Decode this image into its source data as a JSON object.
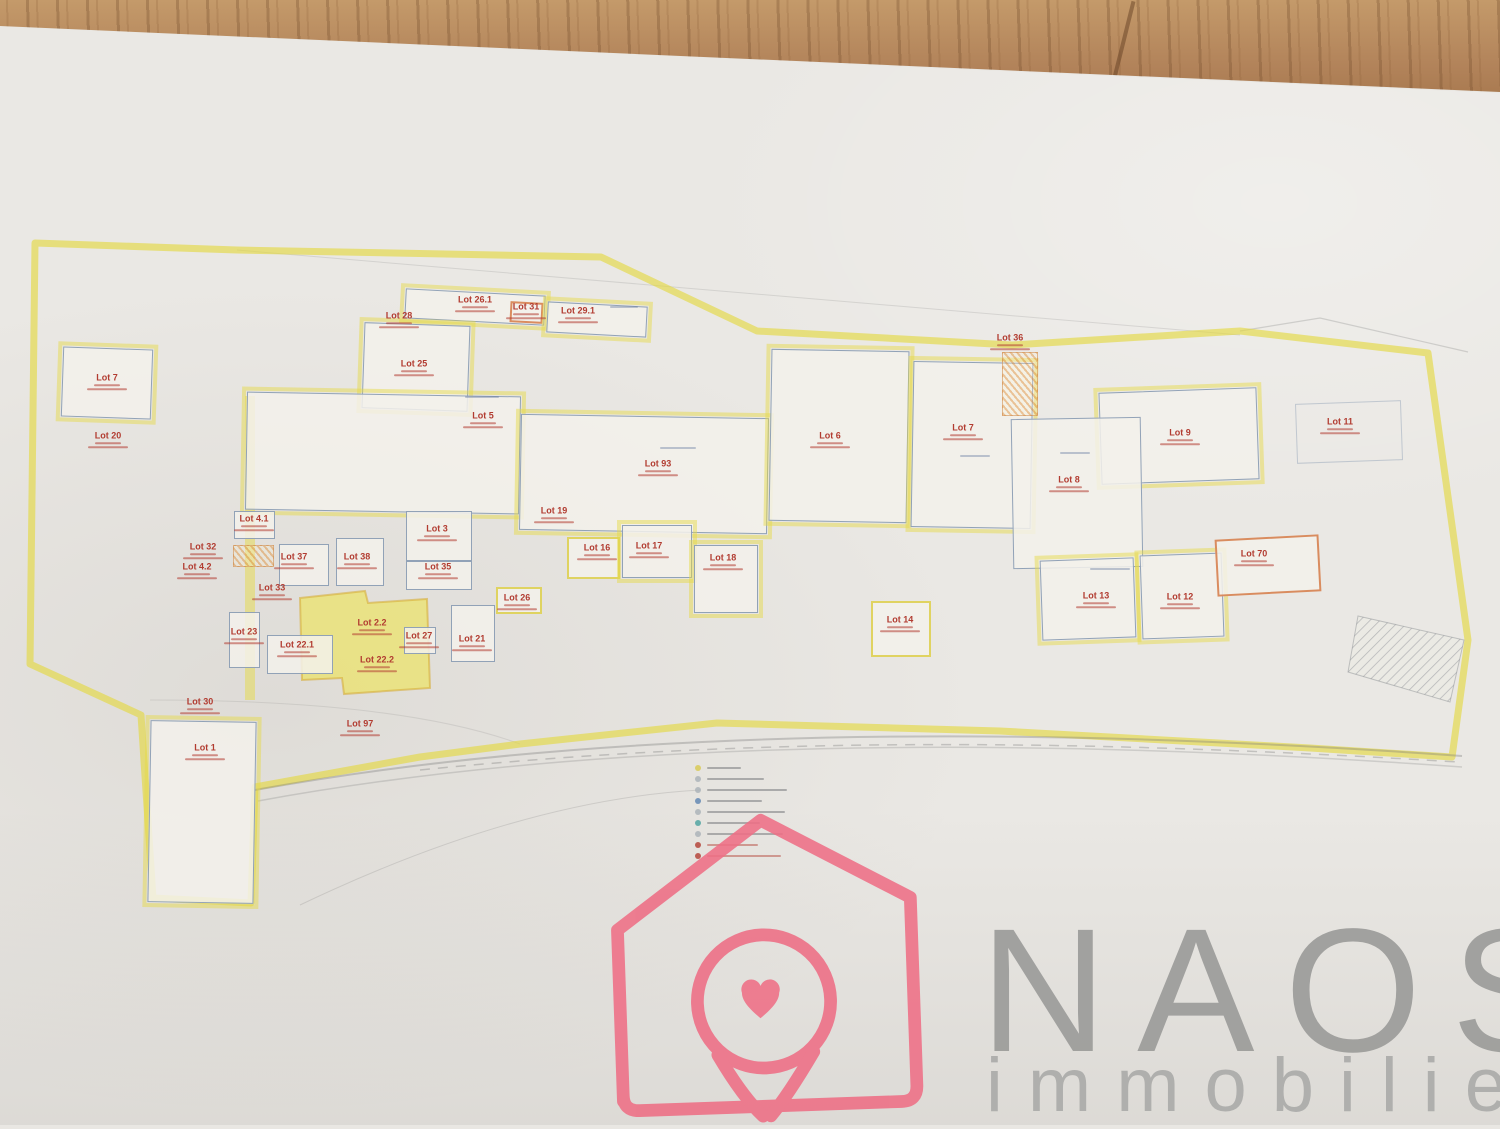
{
  "watermark": {
    "brand": "NAOS",
    "subtitle": "immobilier"
  },
  "colors": {
    "logo_pink": "#ee6e85",
    "brand_gray": "#9c9c9a",
    "subtitle_gray": "#acacaa",
    "boundary_yellow": "#e4d84c",
    "lot_text_red": "#b23c31",
    "parcel_border_blue": "#8094ae",
    "highlight_yellow": "#efe45c",
    "paper": "#eae8e4",
    "wood": "#b2835a"
  },
  "plan": {
    "boundary_points": "35,243 237,250 601,257 757,331 1012,345 1240,331 1428,353 1468,640 1452,757 1310,748 1000,731 717,723 520,744 420,757 255,787 251,903 153,898 141,715 30,664",
    "highlight_polygon": "300,598 365,591 368,603 427,599 430,688 344,694 342,678 302,680",
    "hatch_strip": "1358,616 1464,640 1450,702 1348,672",
    "roads": {
      "main": "M255,790 C520,742 900,716 1462,756",
      "edge": "M258,801 C520,753 900,727 1462,767",
      "dash": "M420,770 C700,742 1000,734 1458,762"
    },
    "path_band": "M250,396 L250,700",
    "lots": [
      {
        "label": "Lot 7",
        "box": [
          62,
          348,
          90,
          70
        ],
        "border": "blueyellow",
        "rot": 2,
        "lx": 107,
        "ly": 382
      },
      {
        "label": "Lot 20",
        "lx": 108,
        "ly": 440
      },
      {
        "label": "Lot 28",
        "lx": 399,
        "ly": 320
      },
      {
        "label": "Lot 26.1",
        "box": [
          405,
          292,
          140,
          30
        ],
        "border": "blueyellow",
        "rot": 3,
        "lx": 475,
        "ly": 304
      },
      {
        "label": "Lot 31",
        "box": [
          510,
          302,
          33,
          21
        ],
        "border": "orange",
        "rot": 3,
        "lx": 526,
        "ly": 311
      },
      {
        "label": "Lot 29.1",
        "box": [
          547,
          304,
          100,
          31
        ],
        "border": "blueyellow",
        "rot": 3,
        "lx": 578,
        "ly": 315
      },
      {
        "label": "Lot 25",
        "box": [
          363,
          324,
          106,
          86
        ],
        "border": "blueyellow",
        "rot": 2,
        "lx": 414,
        "ly": 368
      },
      {
        "label": "Lot 5",
        "box": [
          246,
          394,
          274,
          118
        ],
        "border": "blueyellow",
        "rot": 1,
        "lx": 483,
        "ly": 420
      },
      {
        "label": "Lot 93",
        "box": [
          520,
          416,
          248,
          116
        ],
        "border": "blueyellow",
        "rot": 1,
        "lx": 658,
        "ly": 468
      },
      {
        "label": "Lot 6",
        "box": [
          770,
          350,
          138,
          172
        ],
        "border": "blueyellow",
        "rot": 1,
        "lx": 830,
        "ly": 440
      },
      {
        "label": "Lot 7",
        "box": [
          912,
          362,
          120,
          166
        ],
        "border": "blueyellow",
        "rot": 1,
        "lx": 963,
        "ly": 432
      },
      {
        "label": "Lot 36",
        "lx": 1010,
        "ly": 342,
        "hatch": [
          1002,
          352,
          36,
          64
        ]
      },
      {
        "label": "Lot 9",
        "box": [
          1100,
          390,
          158,
          92
        ],
        "border": "blueyellow",
        "rot": -2,
        "lx": 1180,
        "ly": 437
      },
      {
        "label": "Lot 8",
        "box": [
          1012,
          418,
          130,
          150
        ],
        "border": "blue",
        "rot": -1,
        "lx": 1069,
        "ly": 484
      },
      {
        "label": "Lot 11",
        "box": [
          1296,
          402,
          106,
          60
        ],
        "border": "faint",
        "rot": -2,
        "lx": 1340,
        "ly": 426
      },
      {
        "label": "Lot 4.1",
        "box": [
          234,
          511,
          41,
          28
        ],
        "border": "blue",
        "lx": 254,
        "ly": 523,
        "hatch": [
          233,
          545,
          41,
          22
        ]
      },
      {
        "label": "Lot 32",
        "lx": 203,
        "ly": 551
      },
      {
        "label": "Lot 4.2",
        "lx": 197,
        "ly": 571
      },
      {
        "label": "Lot 37",
        "box": [
          279,
          544,
          50,
          42
        ],
        "border": "blue",
        "lx": 294,
        "ly": 561
      },
      {
        "label": "Lot 38",
        "box": [
          336,
          538,
          48,
          48
        ],
        "border": "blue",
        "lx": 357,
        "ly": 561
      },
      {
        "label": "Lot 3",
        "box": [
          406,
          511,
          66,
          50
        ],
        "border": "blue",
        "lx": 437,
        "ly": 533
      },
      {
        "label": "Lot 35",
        "box": [
          406,
          561,
          66,
          29
        ],
        "border": "blue",
        "lx": 438,
        "ly": 571
      },
      {
        "label": "Lot 19",
        "lx": 554,
        "ly": 515
      },
      {
        "label": "Lot 16",
        "box": [
          567,
          537,
          53,
          42
        ],
        "border": "yellow",
        "lx": 597,
        "ly": 552
      },
      {
        "label": "Lot 17",
        "box": [
          622,
          525,
          70,
          53
        ],
        "border": "blueyellow",
        "lx": 649,
        "ly": 550
      },
      {
        "label": "Lot 18",
        "box": [
          694,
          545,
          64,
          68
        ],
        "border": "blueyellow",
        "lx": 723,
        "ly": 562
      },
      {
        "label": "Lot 33",
        "lx": 272,
        "ly": 592
      },
      {
        "label": "Lot 23",
        "box": [
          229,
          612,
          31,
          56
        ],
        "border": "blue",
        "lx": 244,
        "ly": 636
      },
      {
        "label": "Lot 22.1",
        "box": [
          267,
          635,
          66,
          39
        ],
        "border": "blue",
        "lx": 297,
        "ly": 649
      },
      {
        "label": "Lot 2.2",
        "lx": 372,
        "ly": 627
      },
      {
        "label": "Lot 22.2",
        "lx": 377,
        "ly": 664
      },
      {
        "label": "Lot 27",
        "box": [
          404,
          627,
          32,
          27
        ],
        "border": "blue",
        "lx": 419,
        "ly": 640
      },
      {
        "label": "Lot 21",
        "box": [
          451,
          605,
          44,
          57
        ],
        "border": "blue",
        "lx": 472,
        "ly": 643
      },
      {
        "label": "Lot 26",
        "box": [
          496,
          587,
          46,
          27
        ],
        "border": "yellow",
        "lx": 517,
        "ly": 602
      },
      {
        "label": "Lot 14",
        "box": [
          871,
          601,
          60,
          56
        ],
        "border": "yellow",
        "lx": 900,
        "ly": 624
      },
      {
        "label": "Lot 13",
        "box": [
          1041,
          559,
          94,
          80
        ],
        "border": "blueyellow",
        "rot": -2,
        "lx": 1096,
        "ly": 600
      },
      {
        "label": "Lot 12",
        "box": [
          1141,
          554,
          82,
          84
        ],
        "border": "blueyellow",
        "rot": -2,
        "lx": 1180,
        "ly": 601
      },
      {
        "label": "Lot 70",
        "box": [
          1216,
          537,
          104,
          57
        ],
        "border": "orange",
        "rot": -3,
        "lx": 1254,
        "ly": 558
      },
      {
        "label": "Lot 30",
        "lx": 200,
        "ly": 706
      },
      {
        "label": "Lot 1",
        "box": [
          149,
          721,
          106,
          182
        ],
        "border": "blueyellow",
        "rot": 1,
        "lx": 205,
        "ly": 752
      },
      {
        "label": "Lot 97",
        "lx": 360,
        "ly": 728
      }
    ],
    "legend_markers": [
      "#d8c84e",
      "#a9b0b6",
      "#a9b0b6",
      "#5b82b0",
      "#a9b0b6",
      "#49a09d",
      "#a9b0b6",
      "#b23c31",
      "#b23c31"
    ]
  }
}
